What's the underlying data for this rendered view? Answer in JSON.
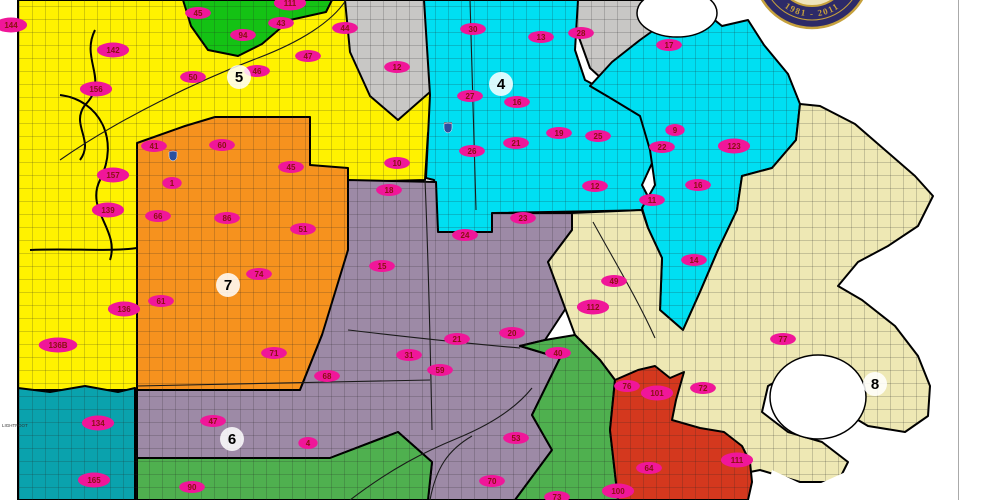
{
  "seal": {
    "years": "1981 - 2011"
  },
  "districts": [
    {
      "number": "4",
      "x": 501,
      "y": 84
    },
    {
      "number": "5",
      "x": 239,
      "y": 77
    },
    {
      "number": "6",
      "x": 232,
      "y": 439
    },
    {
      "number": "7",
      "x": 228,
      "y": 285
    },
    {
      "number": "8",
      "x": 875,
      "y": 384
    }
  ],
  "beats": [
    {
      "x": 11,
      "y": 25,
      "label": "144"
    },
    {
      "x": 113,
      "y": 50,
      "label": "142"
    },
    {
      "x": 96,
      "y": 89,
      "label": "156"
    },
    {
      "x": 198,
      "y": 13,
      "label": "45"
    },
    {
      "x": 243,
      "y": 35,
      "label": "94"
    },
    {
      "x": 281,
      "y": 23,
      "label": "43"
    },
    {
      "x": 290,
      "y": 3,
      "label": "111"
    },
    {
      "x": 345,
      "y": 28,
      "label": "44"
    },
    {
      "x": 308,
      "y": 56,
      "label": "47"
    },
    {
      "x": 193,
      "y": 77,
      "label": "50"
    },
    {
      "x": 257,
      "y": 71,
      "label": "46"
    },
    {
      "x": 113,
      "y": 175,
      "label": "157"
    },
    {
      "x": 108,
      "y": 210,
      "label": "139"
    },
    {
      "x": 124,
      "y": 309,
      "label": "136"
    },
    {
      "x": 58,
      "y": 345,
      "label": "136B"
    },
    {
      "x": 172,
      "y": 183,
      "label": "1"
    },
    {
      "x": 397,
      "y": 163,
      "label": "10"
    },
    {
      "x": 154,
      "y": 146,
      "label": "41"
    },
    {
      "x": 222,
      "y": 145,
      "label": "60"
    },
    {
      "x": 291,
      "y": 167,
      "label": "45"
    },
    {
      "x": 158,
      "y": 216,
      "label": "66"
    },
    {
      "x": 227,
      "y": 218,
      "label": "86"
    },
    {
      "x": 303,
      "y": 229,
      "label": "51"
    },
    {
      "x": 259,
      "y": 274,
      "label": "74"
    },
    {
      "x": 161,
      "y": 301,
      "label": "61"
    },
    {
      "x": 274,
      "y": 353,
      "label": "71"
    },
    {
      "x": 397,
      "y": 67,
      "label": "12"
    },
    {
      "x": 473,
      "y": 29,
      "label": "30"
    },
    {
      "x": 541,
      "y": 37,
      "label": "13"
    },
    {
      "x": 581,
      "y": 33,
      "label": "28"
    },
    {
      "x": 470,
      "y": 96,
      "label": "27"
    },
    {
      "x": 517,
      "y": 102,
      "label": "16"
    },
    {
      "x": 472,
      "y": 151,
      "label": "26"
    },
    {
      "x": 516,
      "y": 143,
      "label": "21"
    },
    {
      "x": 559,
      "y": 133,
      "label": "19"
    },
    {
      "x": 598,
      "y": 136,
      "label": "25"
    },
    {
      "x": 662,
      "y": 147,
      "label": "22"
    },
    {
      "x": 523,
      "y": 218,
      "label": "23"
    },
    {
      "x": 669,
      "y": 45,
      "label": "17"
    },
    {
      "x": 675,
      "y": 130,
      "label": "9"
    },
    {
      "x": 734,
      "y": 146,
      "label": "123"
    },
    {
      "x": 389,
      "y": 190,
      "label": "18"
    },
    {
      "x": 465,
      "y": 235,
      "label": "24"
    },
    {
      "x": 382,
      "y": 266,
      "label": "15"
    },
    {
      "x": 327,
      "y": 376,
      "label": "68"
    },
    {
      "x": 409,
      "y": 355,
      "label": "31"
    },
    {
      "x": 457,
      "y": 339,
      "label": "21"
    },
    {
      "x": 440,
      "y": 370,
      "label": "59"
    },
    {
      "x": 512,
      "y": 333,
      "label": "20"
    },
    {
      "x": 558,
      "y": 353,
      "label": "40"
    },
    {
      "x": 516,
      "y": 438,
      "label": "53"
    },
    {
      "x": 492,
      "y": 481,
      "label": "70"
    },
    {
      "x": 213,
      "y": 421,
      "label": "47"
    },
    {
      "x": 308,
      "y": 443,
      "label": "4"
    },
    {
      "x": 98,
      "y": 423,
      "label": "134"
    },
    {
      "x": 94,
      "y": 480,
      "label": "165"
    },
    {
      "x": 192,
      "y": 487,
      "label": "90"
    },
    {
      "x": 557,
      "y": 497,
      "label": "73"
    },
    {
      "x": 595,
      "y": 186,
      "label": "12"
    },
    {
      "x": 652,
      "y": 200,
      "label": "11"
    },
    {
      "x": 698,
      "y": 185,
      "label": "16"
    },
    {
      "x": 694,
      "y": 260,
      "label": "14"
    },
    {
      "x": 614,
      "y": 281,
      "label": "49"
    },
    {
      "x": 593,
      "y": 307,
      "label": "112"
    },
    {
      "x": 783,
      "y": 339,
      "label": "77"
    },
    {
      "x": 627,
      "y": 386,
      "label": "76"
    },
    {
      "x": 703,
      "y": 388,
      "label": "72"
    },
    {
      "x": 657,
      "y": 393,
      "label": "101"
    },
    {
      "x": 649,
      "y": 468,
      "label": "64"
    },
    {
      "x": 618,
      "y": 491,
      "label": "100"
    },
    {
      "x": 737,
      "y": 460,
      "label": "111"
    }
  ],
  "margin_labels": [
    {
      "text": "LIGHTFOOT",
      "x": 2,
      "y": 427
    }
  ],
  "colors": {
    "district5_yellow": "#FFF200",
    "district4_cyan": "#00DFF2",
    "district7_orange": "#F6921E",
    "district6_purple": "#9D8AA6",
    "district8_tan": "#EEE8B4",
    "gray_zone": "#C8C7C5",
    "green_top_zone": "#14C214",
    "green_bottom_zone": "#4FB04F",
    "red_zone": "#D4381E",
    "teal_zone": "#0AA2AD",
    "beat_fill": "#F01699",
    "beat_text": "#8A1010",
    "district_halo": "#FFFFFF",
    "district_text": "#000000",
    "seal_navy": "#2D2A68",
    "seal_gold": "#C6A13D",
    "seal_inner": "#EFE4BD"
  }
}
